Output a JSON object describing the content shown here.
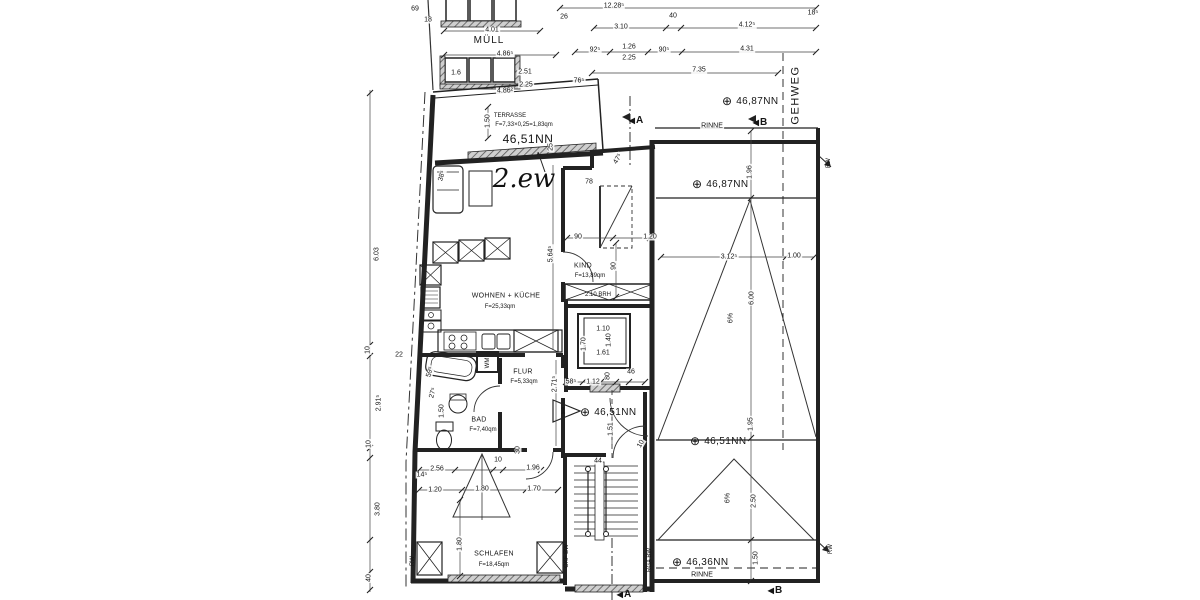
{
  "drawing": {
    "handwritten_title": "2.ew",
    "colors": {
      "line": "#222222",
      "hatch": "#777777",
      "text": "#151515"
    },
    "annotations": [
      {
        "text": "69",
        "x": 415,
        "y": 9,
        "type": "dim",
        "name": "dim-69"
      },
      {
        "text": "18",
        "x": 428,
        "y": 20,
        "type": "dim",
        "name": "dim-18"
      },
      {
        "text": "4.01",
        "x": 492,
        "y": 30,
        "type": "dim",
        "name": "dim-4-01"
      },
      {
        "text": "MÜLL",
        "x": 489,
        "y": 41,
        "type": "muell",
        "name": "label-muell"
      },
      {
        "text": "4.86⁵",
        "x": 505,
        "y": 54,
        "type": "dim",
        "name": "dim-4-86-5"
      },
      {
        "text": "1.6",
        "x": 456,
        "y": 73,
        "type": "dim",
        "name": "dim-1-6"
      },
      {
        "text": "2.51",
        "x": 525,
        "y": 72,
        "type": "dim",
        "name": "dim-2-51"
      },
      {
        "text": "2.25",
        "x": 526,
        "y": 85,
        "type": "dim",
        "name": "dim-2-25-a"
      },
      {
        "text": "4.86²",
        "x": 505,
        "y": 91,
        "type": "dim",
        "name": "dim-4-86-2"
      },
      {
        "text": "26",
        "x": 564,
        "y": 17,
        "type": "dim",
        "name": "dim-26"
      },
      {
        "text": "12.28⁵",
        "x": 614,
        "y": 6,
        "type": "dim",
        "name": "dim-12-28-5"
      },
      {
        "text": "40",
        "x": 673,
        "y": 16,
        "type": "dim",
        "name": "dim-40"
      },
      {
        "text": "4.12⁵",
        "x": 747,
        "y": 25,
        "type": "dim",
        "name": "dim-4-12-5"
      },
      {
        "text": "18⁵",
        "x": 813,
        "y": 13,
        "type": "dim",
        "name": "dim-18-5"
      },
      {
        "text": "3.10",
        "x": 621,
        "y": 27,
        "type": "dim",
        "name": "dim-3-10"
      },
      {
        "text": "92⁵",
        "x": 595,
        "y": 50,
        "type": "dim",
        "name": "dim-92-5"
      },
      {
        "text": "1.26",
        "x": 629,
        "y": 47,
        "type": "dim",
        "name": "dim-1-26"
      },
      {
        "text": "2.25",
        "x": 629,
        "y": 58,
        "type": "dim",
        "name": "dim-2-25-b"
      },
      {
        "text": "90⁵",
        "x": 664,
        "y": 50,
        "type": "dim",
        "name": "dim-90-5"
      },
      {
        "text": "4.31",
        "x": 747,
        "y": 49,
        "type": "dim",
        "name": "dim-4-31"
      },
      {
        "text": "7.35",
        "x": 699,
        "y": 70,
        "type": "dim",
        "name": "dim-7-35"
      },
      {
        "text": "76⁵",
        "x": 579,
        "y": 81,
        "type": "dim",
        "name": "dim-76-5"
      },
      {
        "text": "GEHWEG",
        "x": 796,
        "y": 95,
        "rot": -90,
        "type": "gehweg",
        "name": "label-gehweg"
      },
      {
        "text": "46,87NN",
        "x": 722,
        "y": 101,
        "type": "level",
        "name": "level-46-87-a"
      },
      {
        "text": "RINNE",
        "x": 712,
        "y": 126,
        "type": "dim",
        "name": "label-rinne-top"
      },
      {
        "text": "B",
        "x": 760,
        "y": 123,
        "type": "section",
        "name": "section-b-top"
      },
      {
        "text": "46,87NN",
        "x": 692,
        "y": 184,
        "type": "level",
        "name": "level-46-87-b"
      },
      {
        "text": "1.96",
        "x": 750,
        "y": 172,
        "rot": -90,
        "type": "dim",
        "name": "dim-1-96-roof"
      },
      {
        "text": "RW",
        "x": 829,
        "y": 163,
        "rot": -90,
        "type": "note",
        "name": "label-rw-top"
      },
      {
        "text": "TERRASSE",
        "x": 510,
        "y": 116,
        "type": "note",
        "name": "room-label-terrasse"
      },
      {
        "text": "F=7,33×0,25=1,83qm",
        "x": 524,
        "y": 125,
        "type": "note",
        "name": "area-terrasse"
      },
      {
        "text": "1.50",
        "x": 488,
        "y": 121,
        "rot": -90,
        "type": "dim",
        "name": "dim-1-50-terr"
      },
      {
        "text": "46,51NN",
        "x": 528,
        "y": 139,
        "type": "biglevel",
        "name": "level-46-51-terr"
      },
      {
        "text": "2.ew",
        "x": 524,
        "y": 179,
        "type": "hand",
        "name": "handwritten-2ew"
      },
      {
        "text": "38⁵",
        "x": 442,
        "y": 176,
        "rot": -75,
        "type": "dim",
        "name": "dim-38-5"
      },
      {
        "text": "25",
        "x": 551,
        "y": 147,
        "rot": -90,
        "type": "dim",
        "name": "dim-25"
      },
      {
        "text": "47⁵",
        "x": 618,
        "y": 159,
        "rot": -60,
        "type": "dim",
        "name": "dim-47-5"
      },
      {
        "text": "78",
        "x": 589,
        "y": 182,
        "type": "dim",
        "name": "dim-78"
      },
      {
        "text": "90",
        "x": 578,
        "y": 237,
        "type": "dim",
        "name": "dim-90-kind-a"
      },
      {
        "text": "1.20",
        "x": 650,
        "y": 237,
        "type": "dim",
        "name": "dim-1-20-kind"
      },
      {
        "text": "90",
        "x": 614,
        "y": 266,
        "rot": -90,
        "type": "dim",
        "name": "dim-90-kind-b"
      },
      {
        "text": "KIND",
        "x": 583,
        "y": 266,
        "type": "room",
        "name": "room-label-kind"
      },
      {
        "text": "F=13,89qm",
        "x": 590,
        "y": 276,
        "type": "area",
        "name": "area-kind"
      },
      {
        "text": "5.64⁵",
        "x": 551,
        "y": 254,
        "rot": -90,
        "type": "dim",
        "name": "dim-5-64-5"
      },
      {
        "text": "WOHNEN + KÜCHE",
        "x": 506,
        "y": 296,
        "type": "room",
        "name": "room-label-wohnen"
      },
      {
        "text": "F=25,33qm",
        "x": 500,
        "y": 307,
        "type": "area",
        "name": "area-wohnen"
      },
      {
        "text": "2.10 BRH",
        "x": 598,
        "y": 295,
        "type": "note",
        "name": "note-brh"
      },
      {
        "text": "1.10",
        "x": 603,
        "y": 329,
        "type": "dim",
        "name": "dim-1-10-lift"
      },
      {
        "text": "1.40",
        "x": 609,
        "y": 340,
        "rot": -90,
        "type": "dim",
        "name": "dim-1-40-lift"
      },
      {
        "text": "1.61",
        "x": 603,
        "y": 353,
        "type": "dim",
        "name": "dim-1-61-lift"
      },
      {
        "text": "1.70",
        "x": 584,
        "y": 344,
        "rot": -90,
        "type": "dim",
        "name": "dim-1-70-lift"
      },
      {
        "text": "58⁵",
        "x": 571,
        "y": 382,
        "type": "dim",
        "name": "dim-58-5"
      },
      {
        "text": "1.12",
        "x": 593,
        "y": 382,
        "type": "dim",
        "name": "dim-1-12"
      },
      {
        "text": "80",
        "x": 608,
        "y": 376,
        "rot": -90,
        "type": "dim",
        "name": "dim-80"
      },
      {
        "text": "46",
        "x": 631,
        "y": 372,
        "type": "dim",
        "name": "dim-46"
      },
      {
        "text": "FLUR",
        "x": 523,
        "y": 372,
        "type": "room",
        "name": "room-label-flur"
      },
      {
        "text": "F=5,33qm",
        "x": 524,
        "y": 382,
        "type": "area",
        "name": "area-flur"
      },
      {
        "text": "2.71⁵",
        "x": 555,
        "y": 384,
        "rot": -90,
        "type": "dim",
        "name": "dim-2-71-5"
      },
      {
        "text": "WM",
        "x": 488,
        "y": 363,
        "rot": -90,
        "type": "note",
        "name": "label-wm"
      },
      {
        "text": "BAD",
        "x": 479,
        "y": 420,
        "type": "room",
        "name": "room-label-bad"
      },
      {
        "text": "F=7,40qm",
        "x": 483,
        "y": 430,
        "type": "area",
        "name": "area-bad"
      },
      {
        "text": "1.50",
        "x": 442,
        "y": 411,
        "rot": -90,
        "type": "dim",
        "name": "dim-1-50-bad"
      },
      {
        "text": "27⁵",
        "x": 433,
        "y": 393,
        "rot": -75,
        "type": "dim",
        "name": "dim-27-5"
      },
      {
        "text": "59⁵",
        "x": 430,
        "y": 372,
        "rot": -75,
        "type": "dim",
        "name": "dim-59-5"
      },
      {
        "text": "1",
        "x": 563,
        "y": 411,
        "type": "pos",
        "name": "position-marker-1"
      },
      {
        "text": "46,51NN",
        "x": 580,
        "y": 412,
        "type": "level",
        "name": "level-46-51-entry"
      },
      {
        "text": "1.51",
        "x": 611,
        "y": 429,
        "rot": -90,
        "type": "dim",
        "name": "dim-1-51"
      },
      {
        "text": "10",
        "x": 641,
        "y": 444,
        "rot": -60,
        "type": "dim",
        "name": "dim-10-door"
      },
      {
        "text": "44",
        "x": 598,
        "y": 461,
        "type": "dim",
        "name": "dim-44"
      },
      {
        "text": "RGA BW",
        "x": 650,
        "y": 560,
        "rot": -90,
        "type": "note",
        "name": "label-rga-bw"
      },
      {
        "text": "OKF BW",
        "x": 567,
        "y": 556,
        "rot": -90,
        "type": "note",
        "name": "label-okf-bw"
      },
      {
        "text": "RW",
        "x": 413,
        "y": 561,
        "rot": -90,
        "type": "note",
        "name": "label-rw-left"
      },
      {
        "text": "30",
        "x": 518,
        "y": 450,
        "rot": -90,
        "type": "dim",
        "name": "dim-30"
      },
      {
        "text": "2.56",
        "x": 437,
        "y": 469,
        "type": "dim",
        "name": "dim-2-56"
      },
      {
        "text": "10",
        "x": 498,
        "y": 460,
        "type": "dim",
        "name": "dim-10-schlafen"
      },
      {
        "text": "1.96",
        "x": 533,
        "y": 468,
        "type": "dim",
        "name": "dim-1-96-schlafen"
      },
      {
        "text": "14⁵",
        "x": 422,
        "y": 475,
        "type": "dim",
        "name": "dim-14-5"
      },
      {
        "text": "1.20",
        "x": 435,
        "y": 490,
        "type": "dim",
        "name": "dim-1-20-schlafen"
      },
      {
        "text": "1.80",
        "x": 482,
        "y": 489,
        "type": "dim",
        "name": "dim-1-80-a"
      },
      {
        "text": "1.70",
        "x": 534,
        "y": 489,
        "type": "dim",
        "name": "dim-1-70-schlafen"
      },
      {
        "text": "1.80",
        "x": 460,
        "y": 544,
        "rot": -90,
        "type": "dim",
        "name": "dim-1-80-b"
      },
      {
        "text": "SCHLAFEN",
        "x": 494,
        "y": 554,
        "type": "room",
        "name": "room-label-schlafen"
      },
      {
        "text": "F=18,45qm",
        "x": 494,
        "y": 565,
        "type": "area",
        "name": "area-schlafen"
      },
      {
        "text": "6.03",
        "x": 377,
        "y": 254,
        "rot": -90,
        "type": "dim",
        "name": "dim-6-03"
      },
      {
        "text": "22",
        "x": 399,
        "y": 355,
        "type": "dim",
        "name": "dim-22"
      },
      {
        "text": "10",
        "x": 368,
        "y": 350,
        "rot": -90,
        "type": "dim",
        "name": "dim-10-left-a"
      },
      {
        "text": "2.91⁵",
        "x": 379,
        "y": 403,
        "rot": -90,
        "type": "dim",
        "name": "dim-2-91-5"
      },
      {
        "text": "10",
        "x": 369,
        "y": 444,
        "rot": -90,
        "type": "dim",
        "name": "dim-10-left-b"
      },
      {
        "text": "3.80",
        "x": 378,
        "y": 509,
        "rot": -90,
        "type": "dim",
        "name": "dim-3-80"
      },
      {
        "text": "40",
        "x": 369,
        "y": 578,
        "rot": -90,
        "type": "dim",
        "name": "dim-40-left"
      },
      {
        "text": "3.12⁵",
        "x": 729,
        "y": 257,
        "type": "dim",
        "name": "dim-3-12-5"
      },
      {
        "text": "1.00",
        "x": 794,
        "y": 256,
        "type": "dim",
        "name": "dim-1-00"
      },
      {
        "text": "6.00",
        "x": 752,
        "y": 298,
        "rot": -90,
        "type": "dim",
        "name": "dim-6-00"
      },
      {
        "text": "6%",
        "x": 731,
        "y": 318,
        "rot": -90,
        "type": "dim",
        "name": "slope-6pct-a"
      },
      {
        "text": "46,51NN",
        "x": 690,
        "y": 441,
        "type": "level",
        "name": "level-46-51-roof"
      },
      {
        "text": "1.95",
        "x": 751,
        "y": 424,
        "rot": -90,
        "type": "dim",
        "name": "dim-1-95"
      },
      {
        "text": "6%",
        "x": 728,
        "y": 498,
        "rot": -90,
        "type": "dim",
        "name": "slope-6pct-b"
      },
      {
        "text": "2.50",
        "x": 754,
        "y": 501,
        "rot": -90,
        "type": "dim",
        "name": "dim-2-50"
      },
      {
        "text": "1.50",
        "x": 756,
        "y": 558,
        "rot": -90,
        "type": "dim",
        "name": "dim-1-50-rinne"
      },
      {
        "text": "46,36NN",
        "x": 672,
        "y": 562,
        "type": "level",
        "name": "level-46-36"
      },
      {
        "text": "RINNE",
        "x": 702,
        "y": 575,
        "type": "dim",
        "name": "label-rinne-bottom"
      },
      {
        "text": "RW",
        "x": 831,
        "y": 549,
        "rot": -90,
        "type": "note",
        "name": "label-rw-bottom"
      },
      {
        "text": "A",
        "x": 636,
        "y": 121,
        "type": "section",
        "name": "section-a-top"
      },
      {
        "text": "A",
        "x": 624,
        "y": 595,
        "type": "section",
        "name": "section-a-bottom"
      },
      {
        "text": "B",
        "x": 775,
        "y": 591,
        "type": "section",
        "name": "section-b-bottom"
      }
    ]
  }
}
